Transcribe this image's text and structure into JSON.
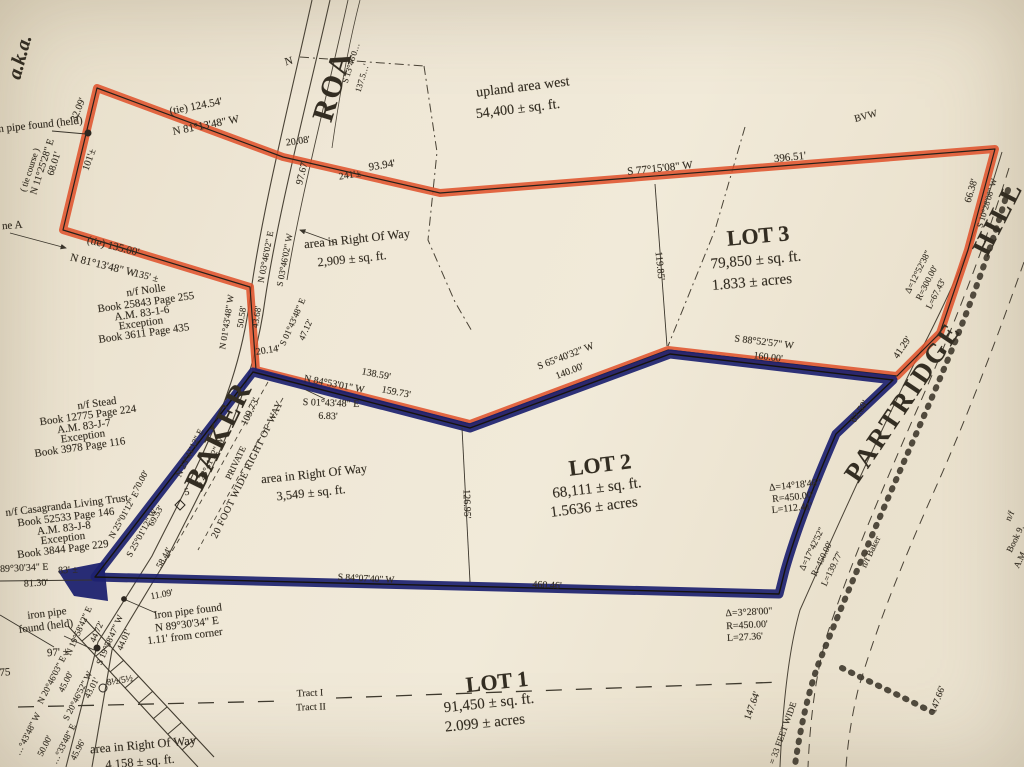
{
  "document": {
    "kind": "scanned survey plat map",
    "lots": [
      {
        "name": "LOT 1",
        "area": "91,450 ± sq. ft.",
        "acres": "2.099 ± acres"
      },
      {
        "name": "LOT 2",
        "area": "68,111 ± sq. ft.",
        "acres": "1.5636 ± acres"
      },
      {
        "name": "LOT 3",
        "area": "79,850 ± sq. ft.",
        "acres": "1.833 ± acres"
      }
    ],
    "roads": [
      "BAKER (PRIVATE, 20 FOOT WIDE RIGHT OF WAY)",
      "PARTRIDGE HILL (= 33 FEET WIDE)",
      "ROAD"
    ],
    "abutters": [
      "n/f Nolle",
      "n/f Stead",
      "n/f Casagranda Living Trust",
      "n/f Baker"
    ],
    "colors": {
      "paper": "#efe7d6",
      "ink": "#332d22",
      "red_highlight": "#df4f28",
      "blue_highlight": "#1e2270"
    }
  },
  "labels": [
    {
      "n": "aka-note",
      "t": "a.k.a.",
      "x": 20,
      "y": 57,
      "r": -75,
      "s": 20,
      "w": 700,
      "it": 1
    },
    {
      "n": "tie-course-label",
      "t": "( tie course )",
      "x": 30,
      "y": 170,
      "r": -72,
      "s": 9
    },
    {
      "n": "tie-course-bearing",
      "t": "N 11°25'28\" E",
      "x": 43,
      "y": 167,
      "r": -72,
      "s": 10
    },
    {
      "n": "tie-course-distance",
      "t": "68.01'",
      "x": 55,
      "y": 164,
      "r": -72,
      "s": 10
    },
    {
      "n": "dim-32-09",
      "t": "32.09'",
      "x": 79,
      "y": 110,
      "r": -68,
      "s": 10
    },
    {
      "n": "dim-101",
      "t": "101'±",
      "x": 90,
      "y": 160,
      "r": -70,
      "s": 10
    },
    {
      "n": "iron-pipe-note-top",
      "t": "iron pipe found (held)",
      "x": -14,
      "y": 126,
      "r": -6,
      "s": 11,
      "al": "l"
    },
    {
      "n": "line-a-label",
      "t": "ne A",
      "x": 2,
      "y": 226,
      "r": -4,
      "s": 11,
      "al": "l"
    },
    {
      "n": "tie-124-54",
      "t": "(tie)   124.54'",
      "x": 196,
      "y": 107,
      "r": -11,
      "s": 11
    },
    {
      "n": "bearing-n811348-1",
      "t": "N 81°13'48\" W",
      "x": 206,
      "y": 126,
      "r": -11,
      "s": 11
    },
    {
      "n": "tie-135-00",
      "t": "(tie)   135.00'",
      "x": 113,
      "y": 247,
      "r": 14,
      "s": 11
    },
    {
      "n": "bearing-n811348-2",
      "t": "N 81°13'48\" W",
      "x": 103,
      "y": 266,
      "r": 14,
      "s": 11
    },
    {
      "n": "dim-135",
      "t": "135' ±",
      "x": 146,
      "y": 277,
      "r": 14,
      "s": 10
    },
    {
      "n": "road-name-roa",
      "t": "ROA",
      "x": 333,
      "y": 86,
      "r": -73,
      "s": 30,
      "w": 700,
      "ls": 2
    },
    {
      "n": "road-bearing-top",
      "t": "S 13°46'0…",
      "x": 351,
      "y": 63,
      "r": -73,
      "s": 8.5
    },
    {
      "n": "road-dim-top",
      "t": "137.5…'",
      "x": 362,
      "y": 78,
      "r": -73,
      "s": 8.5
    },
    {
      "n": "north-mark",
      "t": "N",
      "x": 289,
      "y": 62,
      "r": -15,
      "s": 11
    },
    {
      "n": "dim-20-08",
      "t": "20.08'",
      "x": 298,
      "y": 142,
      "r": -8,
      "s": 10
    },
    {
      "n": "dim-97-67",
      "t": "97.67'",
      "x": 303,
      "y": 173,
      "r": -76,
      "s": 10
    },
    {
      "n": "dim-93-94",
      "t": "93.94'",
      "x": 382,
      "y": 166,
      "r": -9,
      "s": 11
    },
    {
      "n": "dim-241",
      "t": "241'±",
      "x": 350,
      "y": 176,
      "r": -9,
      "s": 10
    },
    {
      "n": "upland-area-label",
      "t": "upland area west",
      "x": 523,
      "y": 88,
      "r": -7,
      "s": 14
    },
    {
      "n": "upland-area-value",
      "t": "54,400 ± sq. ft.",
      "x": 518,
      "y": 110,
      "r": -7,
      "s": 14
    },
    {
      "n": "bvw-label",
      "t": "BVW",
      "x": 866,
      "y": 117,
      "r": -15,
      "s": 10
    },
    {
      "n": "bearing-s771508",
      "t": "S 77°15'08\" W",
      "x": 660,
      "y": 169,
      "r": -6,
      "s": 11
    },
    {
      "n": "dim-396-51",
      "t": "396.51'",
      "x": 790,
      "y": 158,
      "r": -6,
      "s": 11
    },
    {
      "n": "lot3-title",
      "t": "LOT 3",
      "x": 758,
      "y": 236,
      "r": -5,
      "s": 22,
      "w": 700
    },
    {
      "n": "lot3-area",
      "t": "79,850 ± sq. ft.",
      "x": 756,
      "y": 261,
      "r": -5,
      "s": 15
    },
    {
      "n": "lot3-acres",
      "t": "1.833 ± acres",
      "x": 752,
      "y": 283,
      "r": -5,
      "s": 15
    },
    {
      "n": "dim-119-85",
      "t": "119.85'",
      "x": 659,
      "y": 266,
      "r": 84,
      "s": 10
    },
    {
      "n": "road-name-hill",
      "t": "HILL",
      "x": 998,
      "y": 218,
      "r": -63,
      "s": 27,
      "w": 700,
      "ls": 3
    },
    {
      "n": "road-name-partridge",
      "t": "PARTRIDGE",
      "x": 903,
      "y": 402,
      "r": -56,
      "s": 27,
      "w": 700,
      "ls": 3
    },
    {
      "n": "dim-66-38",
      "t": "66.38'",
      "x": 972,
      "y": 191,
      "r": -73,
      "s": 10
    },
    {
      "n": "bearing-east-top",
      "t": "S 10°28'08\" W",
      "x": 987,
      "y": 203,
      "r": -73,
      "s": 8.5
    },
    {
      "n": "curve1-delta",
      "t": "Δ=12°52'38\"",
      "x": 918,
      "y": 272,
      "r": -63,
      "s": 9
    },
    {
      "n": "curve1-radius",
      "t": "R=300.00'",
      "x": 927,
      "y": 283,
      "r": -63,
      "s": 9
    },
    {
      "n": "curve1-arc",
      "t": "L=67.43'",
      "x": 936,
      "y": 294,
      "r": -63,
      "s": 9
    },
    {
      "n": "dim-41-29",
      "t": "41.29'",
      "x": 903,
      "y": 348,
      "r": -56,
      "s": 10
    },
    {
      "n": "dim-62-59",
      "t": "62.59'",
      "x": 860,
      "y": 412,
      "r": -56,
      "s": 10
    },
    {
      "n": "bearing-s885257",
      "t": "S 88°52'57\" W",
      "x": 764,
      "y": 343,
      "r": 7,
      "s": 10
    },
    {
      "n": "dim-160-00",
      "t": "160.00'",
      "x": 768,
      "y": 358,
      "r": 7,
      "s": 10
    },
    {
      "n": "bearing-s654032",
      "t": "S 65°40'32\" W",
      "x": 566,
      "y": 357,
      "r": -21,
      "s": 10
    },
    {
      "n": "dim-140-00",
      "t": "140.00'",
      "x": 570,
      "y": 372,
      "r": -21,
      "s": 10
    },
    {
      "n": "dim-138-59",
      "t": "138.59'",
      "x": 376,
      "y": 375,
      "r": 11,
      "s": 10
    },
    {
      "n": "bearing-n845301",
      "t": "N 84°53'01\" W",
      "x": 334,
      "y": 385,
      "r": 11,
      "s": 10
    },
    {
      "n": "dim-159-73",
      "t": "159.73'",
      "x": 396,
      "y": 393,
      "r": 11,
      "s": 10
    },
    {
      "n": "bearing-s014348-mid",
      "t": "S 01°43'48\" E",
      "x": 331,
      "y": 404,
      "r": 2,
      "s": 10
    },
    {
      "n": "dim-6-83",
      "t": "6.83'",
      "x": 328,
      "y": 417,
      "r": 2,
      "s": 10
    },
    {
      "n": "bearing-n014348w",
      "t": "N 01°43'48\" W",
      "x": 227,
      "y": 322,
      "r": -81,
      "s": 9
    },
    {
      "n": "dim-50-58",
      "t": "50.58'",
      "x": 242,
      "y": 317,
      "r": -81,
      "s": 9
    },
    {
      "n": "dim-43-68",
      "t": "43.68'",
      "x": 257,
      "y": 317,
      "r": -81,
      "s": 9
    },
    {
      "n": "bearing-n034602",
      "t": "N 03°46'02\" E",
      "x": 266,
      "y": 257,
      "r": -79,
      "s": 9
    },
    {
      "n": "bearing-s034602",
      "t": "S 03°46'02\" W",
      "x": 285,
      "y": 260,
      "r": -79,
      "s": 9
    },
    {
      "n": "bearing-s014348-road",
      "t": "S 01°43'48\" E",
      "x": 293,
      "y": 322,
      "r": -66,
      "s": 9
    },
    {
      "n": "dim-47-12",
      "t": "47.12'",
      "x": 306,
      "y": 330,
      "r": -66,
      "s": 9
    },
    {
      "n": "dim-20-14",
      "t": "20.14'",
      "x": 268,
      "y": 351,
      "r": -9,
      "s": 10
    },
    {
      "n": "nolle-1",
      "t": "n/f Nolle",
      "x": 146,
      "y": 291,
      "r": -8,
      "s": 11
    },
    {
      "n": "nolle-2",
      "t": "Book 25843 Page 255",
      "x": 146,
      "y": 303,
      "r": -8,
      "s": 11
    },
    {
      "n": "nolle-3",
      "t": "A.M. 83-1-6",
      "x": 142,
      "y": 314,
      "r": -8,
      "s": 11
    },
    {
      "n": "nolle-4",
      "t": "Exception",
      "x": 141,
      "y": 324,
      "r": -8,
      "s": 11
    },
    {
      "n": "nolle-5",
      "t": "Book 3611 Page 435",
      "x": 144,
      "y": 334,
      "r": -8,
      "s": 11
    },
    {
      "n": "area-row2-label",
      "t": "area in Right Of Way",
      "x": 357,
      "y": 239,
      "r": -6,
      "s": 12.5
    },
    {
      "n": "area-row2-value",
      "t": "2,909 ± sq. ft.",
      "x": 352,
      "y": 259,
      "r": -6,
      "s": 12.5
    },
    {
      "n": "stead-1",
      "t": "n/f Stead",
      "x": 97,
      "y": 404,
      "r": -8,
      "s": 11
    },
    {
      "n": "stead-2",
      "t": "Book 12775 Page 224",
      "x": 88,
      "y": 416,
      "r": -8,
      "s": 11
    },
    {
      "n": "stead-3",
      "t": "A.M. 83-J-7",
      "x": 84,
      "y": 427,
      "r": -8,
      "s": 11
    },
    {
      "n": "stead-4",
      "t": "Exception",
      "x": 83,
      "y": 437,
      "r": -8,
      "s": 11
    },
    {
      "n": "stead-5",
      "t": "Book 3978 Page 116",
      "x": 80,
      "y": 448,
      "r": -8,
      "s": 11
    },
    {
      "n": "road-name-baker",
      "t": "BAKER",
      "x": 219,
      "y": 436,
      "r": -64,
      "s": 30,
      "w": 700,
      "ls": 2
    },
    {
      "n": "dim-109-73",
      "t": "109.73'",
      "x": 251,
      "y": 412,
      "r": -64,
      "s": 10
    },
    {
      "n": "road-private",
      "t": "PRIVATE",
      "x": 236,
      "y": 463,
      "r": -64,
      "s": 9
    },
    {
      "n": "road-bearing-s234112",
      "t": "S 23°41'12\" W",
      "x": 210,
      "y": 462,
      "r": -64,
      "s": 9
    },
    {
      "n": "road-bearing-n234112",
      "t": "N 23°41'12\" E",
      "x": 190,
      "y": 453,
      "r": -64,
      "s": 9
    },
    {
      "n": "station-5",
      "t": "5",
      "x": 187,
      "y": 493,
      "r": -10,
      "s": 10
    },
    {
      "n": "row-20ft",
      "t": "20 FOOT WIDE RIGHT OF WAY",
      "x": 248,
      "y": 470,
      "r": -64,
      "s": 10,
      "ls": 0.5
    },
    {
      "n": "area-row3-label",
      "t": "area in Right Of Way",
      "x": 314,
      "y": 474,
      "r": -6,
      "s": 12.5
    },
    {
      "n": "area-row3-value",
      "t": "3,549 ± sq. ft.",
      "x": 311,
      "y": 493,
      "r": -6,
      "s": 12.5
    },
    {
      "n": "lot2-title",
      "t": "LOT 2",
      "x": 600,
      "y": 465,
      "r": -7,
      "s": 22,
      "w": 700
    },
    {
      "n": "lot2-area",
      "t": "68,111 ± sq. ft.",
      "x": 597,
      "y": 489,
      "r": -7,
      "s": 15
    },
    {
      "n": "lot2-acres",
      "t": "1.5636 ± acres",
      "x": 594,
      "y": 508,
      "r": -7,
      "s": 15
    },
    {
      "n": "dim-126-95",
      "t": "126.95'",
      "x": 466,
      "y": 504,
      "r": 88,
      "s": 10
    },
    {
      "n": "curve2-delta",
      "t": "Δ=14°18'46\"",
      "x": 795,
      "y": 486,
      "r": -6,
      "s": 10
    },
    {
      "n": "curve2-radius",
      "t": "R=450.00'",
      "x": 793,
      "y": 498,
      "r": -6,
      "s": 10
    },
    {
      "n": "curve2-arc",
      "t": "L=112.41'",
      "x": 792,
      "y": 509,
      "r": -6,
      "s": 10
    },
    {
      "n": "curve3-delta",
      "t": "Δ=17°42'52\"",
      "x": 812,
      "y": 549,
      "r": -64,
      "s": 9
    },
    {
      "n": "curve3-radius",
      "t": "R=450.00'",
      "x": 822,
      "y": 559,
      "r": -64,
      "s": 9
    },
    {
      "n": "curve3-arc",
      "t": "L=139.77'",
      "x": 832,
      "y": 569,
      "r": -64,
      "s": 9
    },
    {
      "n": "nf-baker",
      "t": "n/f Baker",
      "x": 871,
      "y": 552,
      "r": -64,
      "s": 9
    },
    {
      "n": "abutter-right-1",
      "t": "n/f",
      "x": 1010,
      "y": 516,
      "r": -64,
      "s": 9
    },
    {
      "n": "abutter-right-2",
      "t": "Book 9…",
      "x": 1017,
      "y": 536,
      "r": -64,
      "s": 9
    },
    {
      "n": "abutter-right-3",
      "t": "A.M. …",
      "x": 1023,
      "y": 554,
      "r": -64,
      "s": 9
    },
    {
      "n": "bearing-n250112",
      "t": "N 25°01'12\" E",
      "x": 124,
      "y": 515,
      "r": -61,
      "s": 9
    },
    {
      "n": "dim-70-00",
      "t": "70.00'",
      "x": 141,
      "y": 481,
      "r": -61,
      "s": 9
    },
    {
      "n": "bearing-s250112",
      "t": "S 25°01'12\" W",
      "x": 142,
      "y": 533,
      "r": -61,
      "s": 9
    },
    {
      "n": "dim-69-53",
      "t": "69.53'",
      "x": 156,
      "y": 516,
      "r": -61,
      "s": 9
    },
    {
      "n": "dim-58-44",
      "t": "58.44'",
      "x": 164,
      "y": 558,
      "r": -61,
      "s": 9
    },
    {
      "n": "casagranda-1",
      "t": "n/f Casagranda Living Trust",
      "x": 67,
      "y": 506,
      "r": -7,
      "s": 11
    },
    {
      "n": "casagranda-2",
      "t": "Book 52533 Page 146",
      "x": 66,
      "y": 518,
      "r": -7,
      "s": 11
    },
    {
      "n": "casagranda-3",
      "t": "A.M. 83-J-8",
      "x": 64,
      "y": 529,
      "r": -7,
      "s": 11
    },
    {
      "n": "casagranda-4",
      "t": "Exception",
      "x": 63,
      "y": 539,
      "r": -7,
      "s": 11
    },
    {
      "n": "casagranda-5",
      "t": "Book 3844 Page 229",
      "x": 63,
      "y": 550,
      "r": -7,
      "s": 11
    },
    {
      "n": "bearing-s893034",
      "t": "S 89°30'34\" E",
      "x": -8,
      "y": 569,
      "r": -3,
      "s": 10,
      "al": "l"
    },
    {
      "n": "dim-83",
      "t": "83' ±",
      "x": 68,
      "y": 571,
      "r": -3,
      "s": 10
    },
    {
      "n": "dim-81-30",
      "t": "81.30'",
      "x": 36,
      "y": 584,
      "r": -3,
      "s": 10
    },
    {
      "n": "iron-pipe-bl-1",
      "t": "iron pipe",
      "x": 47,
      "y": 614,
      "r": -7,
      "s": 11
    },
    {
      "n": "iron-pipe-bl-2",
      "t": "found (held)",
      "x": 46,
      "y": 627,
      "r": -7,
      "s": 11
    },
    {
      "n": "dim-97pm",
      "t": "97' ±",
      "x": 58,
      "y": 653,
      "r": -4,
      "s": 11
    },
    {
      "n": "dim-75",
      "t": "75",
      "x": 5,
      "y": 673,
      "r": -4,
      "s": 11
    },
    {
      "n": "iron-pipe-corner-1",
      "t": "Iron pipe found",
      "x": 188,
      "y": 612,
      "r": -7,
      "s": 11
    },
    {
      "n": "iron-pipe-corner-2",
      "t": "N 89°30'34\" E",
      "x": 187,
      "y": 625,
      "r": -7,
      "s": 11
    },
    {
      "n": "iron-pipe-corner-3",
      "t": "1.11' from corner",
      "x": 185,
      "y": 637,
      "r": -7,
      "s": 11
    },
    {
      "n": "dim-11-09",
      "t": "11.09'",
      "x": 162,
      "y": 596,
      "r": -10,
      "s": 9.5
    },
    {
      "n": "bearing-n195842",
      "t": "N 19°58'42\" E",
      "x": 79,
      "y": 631,
      "r": -66,
      "s": 9
    },
    {
      "n": "dim-44-72",
      "t": "44.72'",
      "x": 97,
      "y": 632,
      "r": -66,
      "s": 9
    },
    {
      "n": "bearing-s195847",
      "t": "S 19°58'47\" W",
      "x": 110,
      "y": 640,
      "r": -66,
      "s": 9
    },
    {
      "n": "dim-44-01",
      "t": "44.01'",
      "x": 124,
      "y": 640,
      "r": -66,
      "s": 9
    },
    {
      "n": "tree-size",
      "t": "8½/5½",
      "x": 120,
      "y": 682,
      "r": -10,
      "s": 9.5
    },
    {
      "n": "bearing-n204603",
      "t": "N 20°46'03\" E",
      "x": 52,
      "y": 680,
      "r": -63,
      "s": 9
    },
    {
      "n": "dim-45-00",
      "t": "45.00'",
      "x": 66,
      "y": 682,
      "r": -63,
      "s": 9
    },
    {
      "n": "bearing-s204652",
      "t": "S 20°46'52\" W",
      "x": 78,
      "y": 696,
      "r": -63,
      "s": 9
    },
    {
      "n": "dim-43-01",
      "t": "43.01'",
      "x": 92,
      "y": 688,
      "r": -63,
      "s": 9
    },
    {
      "n": "bearing-left-1",
      "t": "…°43'48\" W",
      "x": 28,
      "y": 734,
      "r": -63,
      "s": 9
    },
    {
      "n": "dim-50-00",
      "t": "50.00'",
      "x": 45,
      "y": 746,
      "r": -63,
      "s": 9
    },
    {
      "n": "bearing-left-2",
      "t": "…°33'48\" E",
      "x": 64,
      "y": 744,
      "r": -63,
      "s": 9
    },
    {
      "n": "dim-45-96",
      "t": "45.96'",
      "x": 78,
      "y": 750,
      "r": -63,
      "s": 9
    },
    {
      "n": "area-row1-label",
      "t": "area in Right Of Way",
      "x": 143,
      "y": 745,
      "r": -5,
      "s": 12.5
    },
    {
      "n": "area-row1-value",
      "t": "4,158 ± sq. ft.",
      "x": 140,
      "y": 762,
      "r": -5,
      "s": 12.5
    },
    {
      "n": "tract-i",
      "t": "Tract I",
      "x": 310,
      "y": 694,
      "r": -2,
      "s": 10
    },
    {
      "n": "tract-ii",
      "t": "Tract II",
      "x": 311,
      "y": 708,
      "r": -2,
      "s": 10
    },
    {
      "n": "lot1-title",
      "t": "LOT 1",
      "x": 497,
      "y": 682,
      "r": -6,
      "s": 22,
      "w": 700
    },
    {
      "n": "lot1-area",
      "t": "91,450 ± sq. ft.",
      "x": 489,
      "y": 704,
      "r": -6,
      "s": 15
    },
    {
      "n": "lot1-acres",
      "t": "2.099 ± acres",
      "x": 485,
      "y": 724,
      "r": -6,
      "s": 15
    },
    {
      "n": "bearing-bottom",
      "t": "S 84°07'40\" W",
      "x": 366,
      "y": 580,
      "r": 3,
      "s": 9.5
    },
    {
      "n": "dim-460-46",
      "t": "460.46'",
      "x": 547,
      "y": 586,
      "r": 3,
      "s": 10
    },
    {
      "n": "curve4-delta",
      "t": "Δ=3°28'00\"",
      "x": 749,
      "y": 613,
      "r": -3,
      "s": 10
    },
    {
      "n": "curve4-radius",
      "t": "R=450.00'",
      "x": 747,
      "y": 626,
      "r": -3,
      "s": 10
    },
    {
      "n": "curve4-arc",
      "t": "L=27.36'",
      "x": 745,
      "y": 638,
      "r": -3,
      "s": 10
    },
    {
      "n": "dim-147-64",
      "t": "147.64'",
      "x": 753,
      "y": 706,
      "r": -70,
      "s": 10
    },
    {
      "n": "road-33ft",
      "t": "= 33 FEET WIDE",
      "x": 783,
      "y": 733,
      "r": -70,
      "s": 9
    },
    {
      "n": "dim-147-66",
      "t": "147.66'",
      "x": 939,
      "y": 700,
      "r": -70,
      "s": 9.5
    }
  ]
}
